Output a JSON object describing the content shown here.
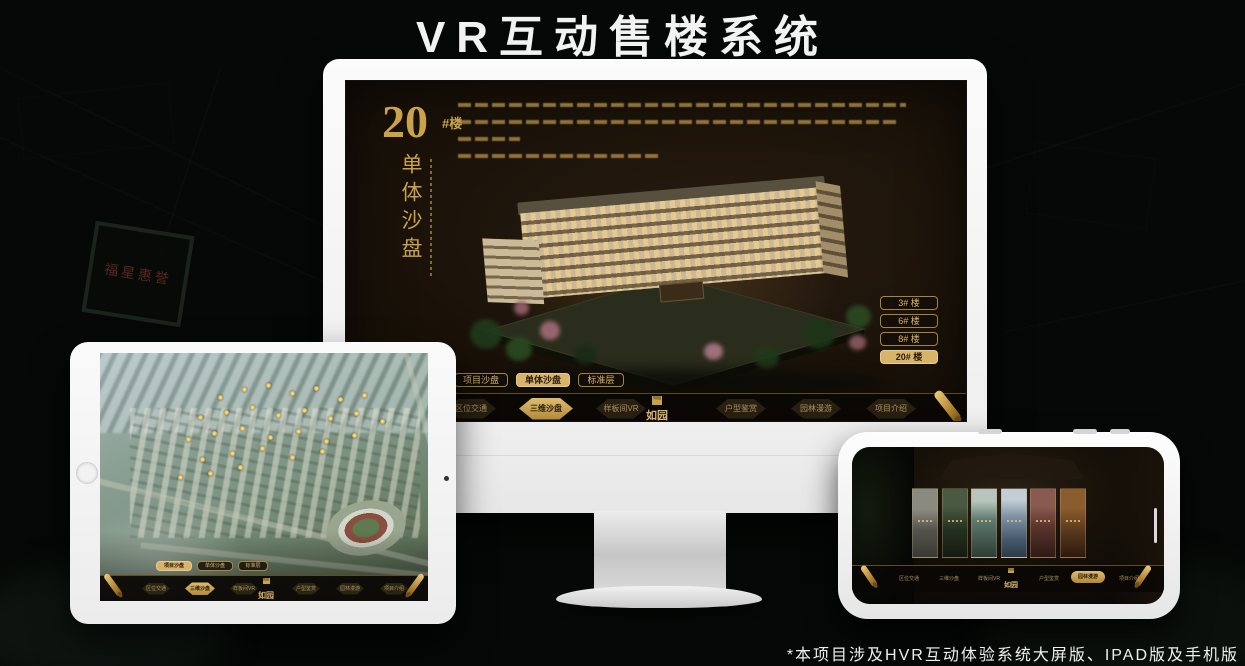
{
  "page": {
    "title": "VR互动售楼系统",
    "footnote": "*本项目涉及HVR互动体验系统大屏版、IPAD版及手机版"
  },
  "background": {
    "plaque_text": "福星惠誉"
  },
  "colors": {
    "gold": "#c9a24a",
    "gold_bright": "#e0bc6e",
    "screen_bg": "#1a1209"
  },
  "monitor": {
    "headline": {
      "number": "20",
      "unit": "#楼",
      "vertical": "单体沙盘"
    },
    "floor_buttons": [
      {
        "label": "3# 楼"
      },
      {
        "label": "6# 楼"
      },
      {
        "label": "8# 楼"
      },
      {
        "label": "20# 楼"
      }
    ],
    "sub_tabs": [
      {
        "label": "项目沙盘"
      },
      {
        "label": "单体沙盘"
      },
      {
        "label": "标准层"
      }
    ]
  },
  "nav": {
    "left": [
      {
        "label": "区位交通"
      },
      {
        "label": "三维沙盘"
      },
      {
        "label": "样板间VR"
      }
    ],
    "logo": "如园",
    "right": [
      {
        "label": "户型鉴赏"
      },
      {
        "label": "园林漫游"
      },
      {
        "label": "项目介绍"
      }
    ]
  }
}
